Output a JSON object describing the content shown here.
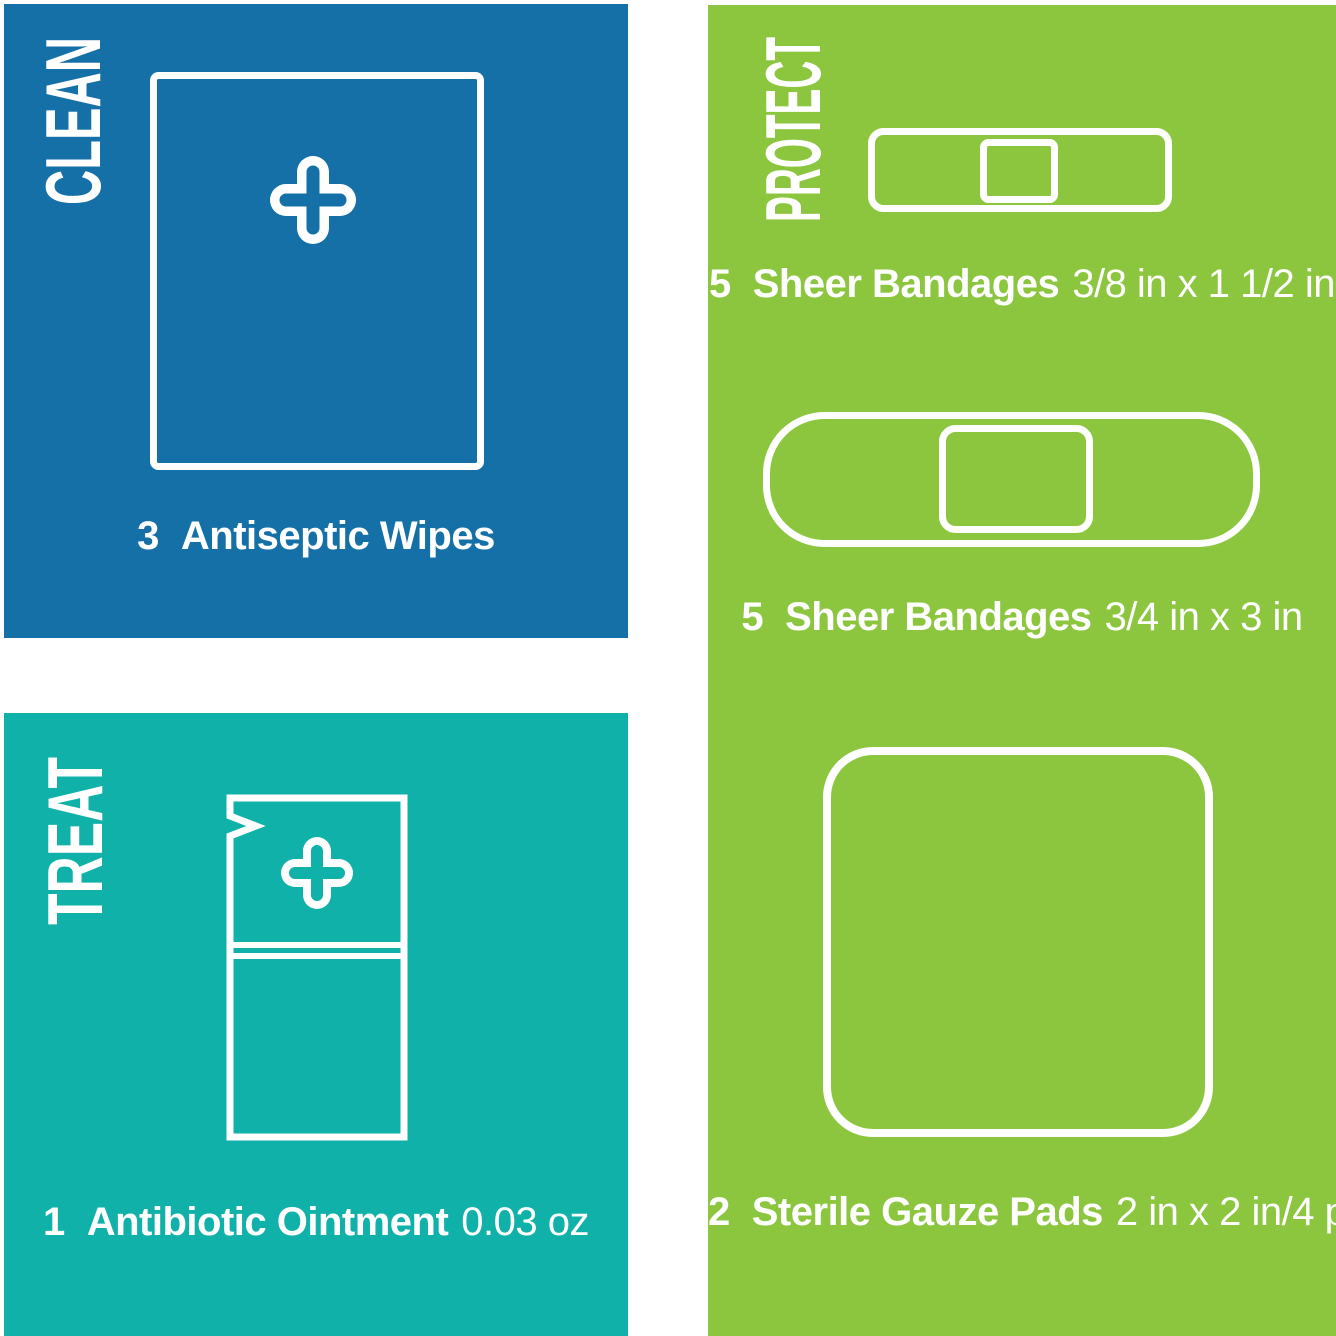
{
  "colors": {
    "clean_bg": "#1470A6",
    "treat_bg": "#0FB1A8",
    "protect_bg": "#8CC63F",
    "text": "#FFFFFF",
    "icon_stroke": "#FFFFFF"
  },
  "panels": {
    "clean": {
      "header": "CLEAN",
      "items": [
        {
          "qty": "3",
          "name": "Antiseptic Wipes",
          "spec": "",
          "icon": "antiseptic-wipe-icon"
        }
      ]
    },
    "treat": {
      "header": "TREAT",
      "items": [
        {
          "qty": "1",
          "name": "Antibiotic Ointment",
          "spec": "0.03 oz",
          "icon": "ointment-packet-icon"
        }
      ]
    },
    "protect": {
      "header": "PROTECT",
      "items": [
        {
          "qty": "5",
          "name": "Sheer Bandages",
          "spec": "3/8 in x 1 1/2 in",
          "icon": "small-sheer-bandage-icon"
        },
        {
          "qty": "5",
          "name": "Sheer Bandages",
          "spec": "3/4 in x 3 in",
          "icon": "large-sheer-bandage-icon"
        },
        {
          "qty": "2",
          "name": "Sterile Gauze Pads",
          "spec": "2 in x 2 in/4 ply",
          "icon": "sterile-gauze-pad-icon"
        }
      ]
    }
  }
}
